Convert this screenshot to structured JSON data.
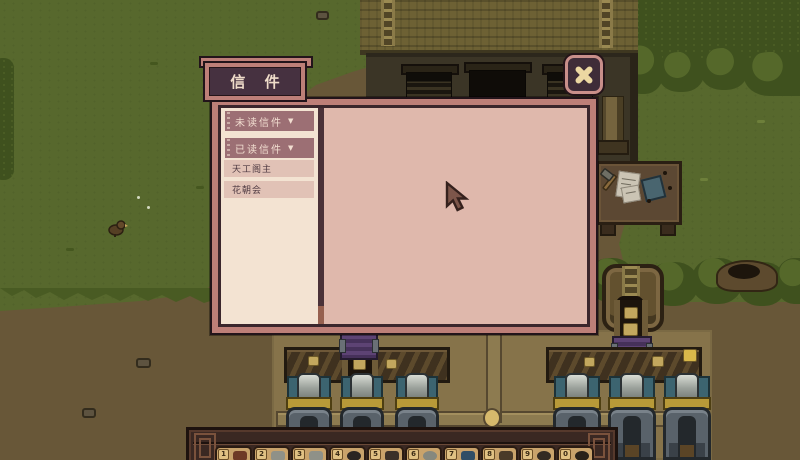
{
  "mail_panel": {
    "title": "信 件",
    "filters": [
      {
        "label": "未读信件",
        "arrow": "▼"
      },
      {
        "label": "已读信件",
        "arrow": "▼"
      }
    ],
    "letters": [
      {
        "label": "天工阁主"
      },
      {
        "label": "花朝会"
      }
    ]
  },
  "hotbar": {
    "slots": [
      {
        "number": "1"
      },
      {
        "number": "2"
      },
      {
        "number": "3"
      },
      {
        "number": "4"
      },
      {
        "number": "5"
      },
      {
        "number": "6"
      },
      {
        "number": "7"
      },
      {
        "number": "8"
      },
      {
        "number": "9"
      },
      {
        "number": "0"
      }
    ]
  },
  "icons": {
    "close": "close-x",
    "filter_arrow": "chevron-down"
  },
  "colors": {
    "panel_frame": "#bd7f78",
    "panel_trim_dark": "#3a262c",
    "sidebar_bg": "#f3e3d2",
    "content_bg": "#dfb8ac",
    "filter_button_bg": "#9c6f74",
    "letter_row_bg": "#e1c2b6",
    "title_tab_bg": "#463140",
    "close_x": "#ecd7a2",
    "grass": "#57682d",
    "dirt": "#685738",
    "factory_floor": "#86734a"
  }
}
